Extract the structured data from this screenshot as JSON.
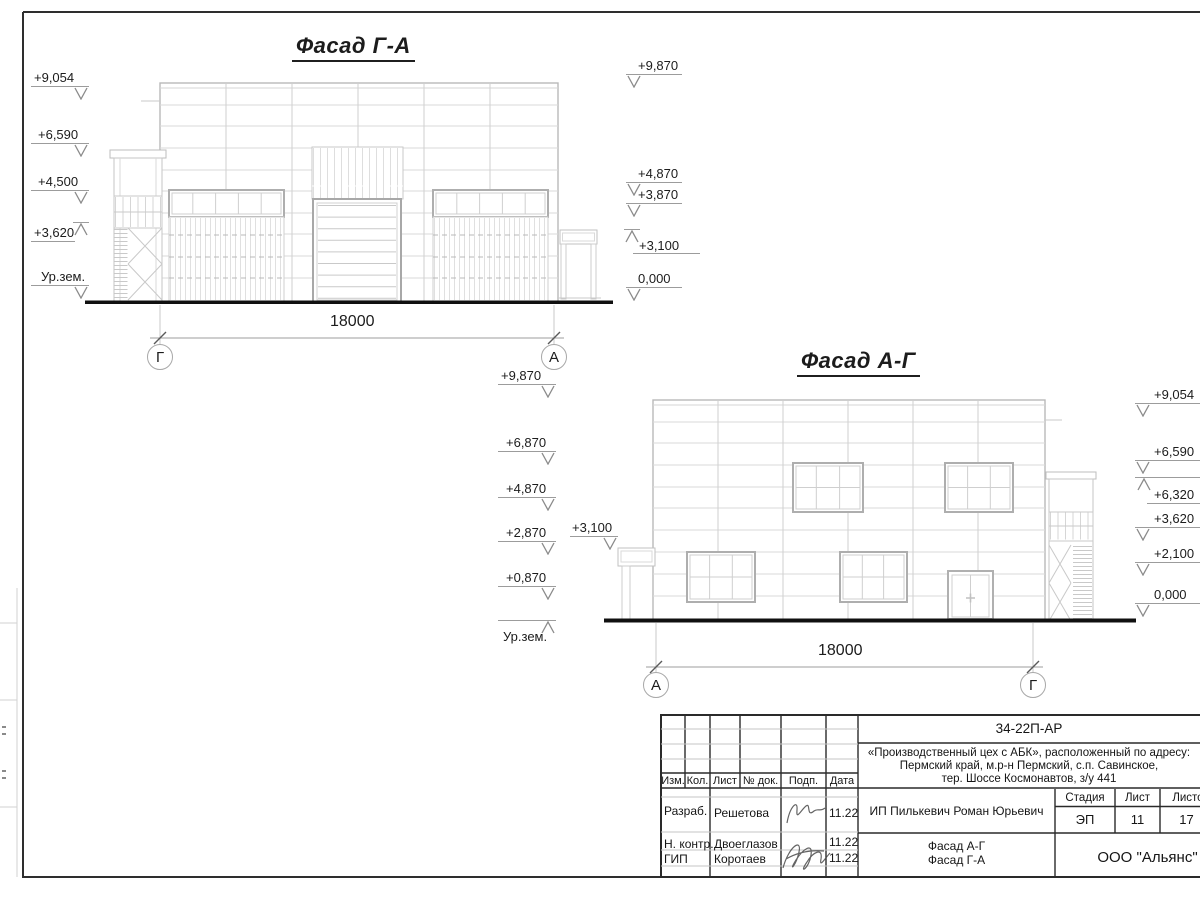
{
  "facade_ga": {
    "title": "Фасад Г-А",
    "dimension": "18000",
    "axis_left": "Г",
    "axis_right": "А",
    "marks_left": [
      "+9,054",
      "+6,590",
      "+4,500",
      "+3,620",
      "Ур.зем."
    ],
    "marks_right": [
      "+9,870",
      "+4,870",
      "+3,870",
      "+3,100",
      "0,000"
    ]
  },
  "facade_ag": {
    "title": "Фасад А-Г",
    "dimension": "18000",
    "axis_left": "А",
    "axis_right": "Г",
    "marks_left": [
      "+9,870",
      "+6,870",
      "+4,870",
      "+2,870",
      "+0,870",
      "Ур.зем."
    ],
    "canopy_mark": "+3,100",
    "marks_right": [
      "+9,054",
      "+6,590",
      "+6,320",
      "+3,620",
      "+2,100",
      "0,000"
    ]
  },
  "stamp": {
    "doc_code": "34-22П-АР",
    "address_lines": [
      "«Производственный цех с АБК», расположенный по адресу:",
      "Пермский край, м.р-н Пермский, с.п. Савинское,",
      "тер. Шоссе Космонавтов, з/у 441"
    ],
    "columns": [
      "Изм.",
      "Кол.",
      "Лист",
      "№ док.",
      "Подп.",
      "Дата"
    ],
    "rows": [
      {
        "role": "Разраб.",
        "name": "Решетова",
        "date": "11.22"
      },
      {
        "role": "Н. контр.",
        "name": "Двоеглазов",
        "date": "11.22"
      },
      {
        "role": "ГИП",
        "name": "Коротаев",
        "date": "11.22"
      }
    ],
    "client": "ИП Пилькевич Роман Юрьевич",
    "stage_label": "Стадия",
    "sheet_label": "Лист",
    "sheets_label": "Листов",
    "stage": "ЭП",
    "sheet_no": "11",
    "sheets_total": "17",
    "titles": [
      "Фасад А-Г",
      "Фасад Г-А"
    ],
    "company": "ООО \"Альянс\""
  }
}
